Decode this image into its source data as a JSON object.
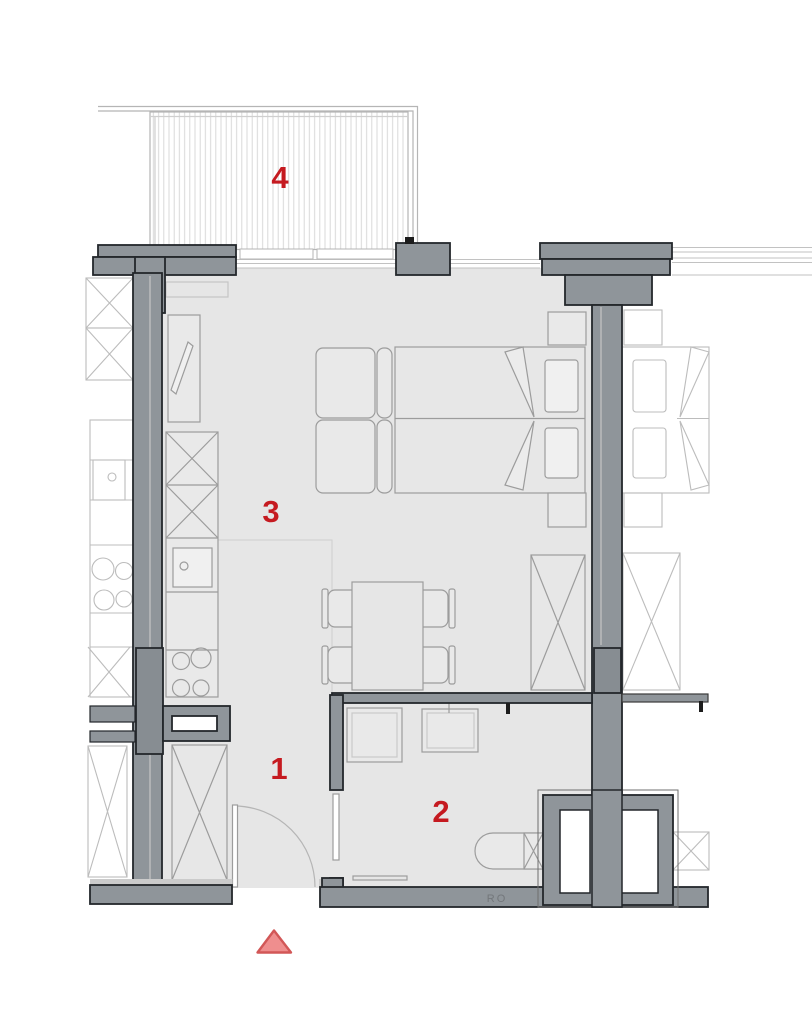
{
  "plan": {
    "type": "apartment-floor-plan",
    "room_labels": [
      {
        "number": "1",
        "area": "hallway"
      },
      {
        "number": "2",
        "area": "bathroom"
      },
      {
        "number": "3",
        "area": "living-kitchen"
      },
      {
        "number": "4",
        "area": "balcony"
      }
    ],
    "wall_inscription": "RO",
    "entrance_marker": "entrance-direction-triangle",
    "colors": {
      "label_red": "#c51a20",
      "wall_gray": "#8f959a",
      "wall_dark": "#878d92",
      "floor_gray": "#e6e6e6",
      "furniture_line": "#9c9c9c",
      "neighbor_line": "#bcbcbc",
      "marker_fill": "#ef8e8e",
      "marker_stroke": "#d25757"
    }
  }
}
